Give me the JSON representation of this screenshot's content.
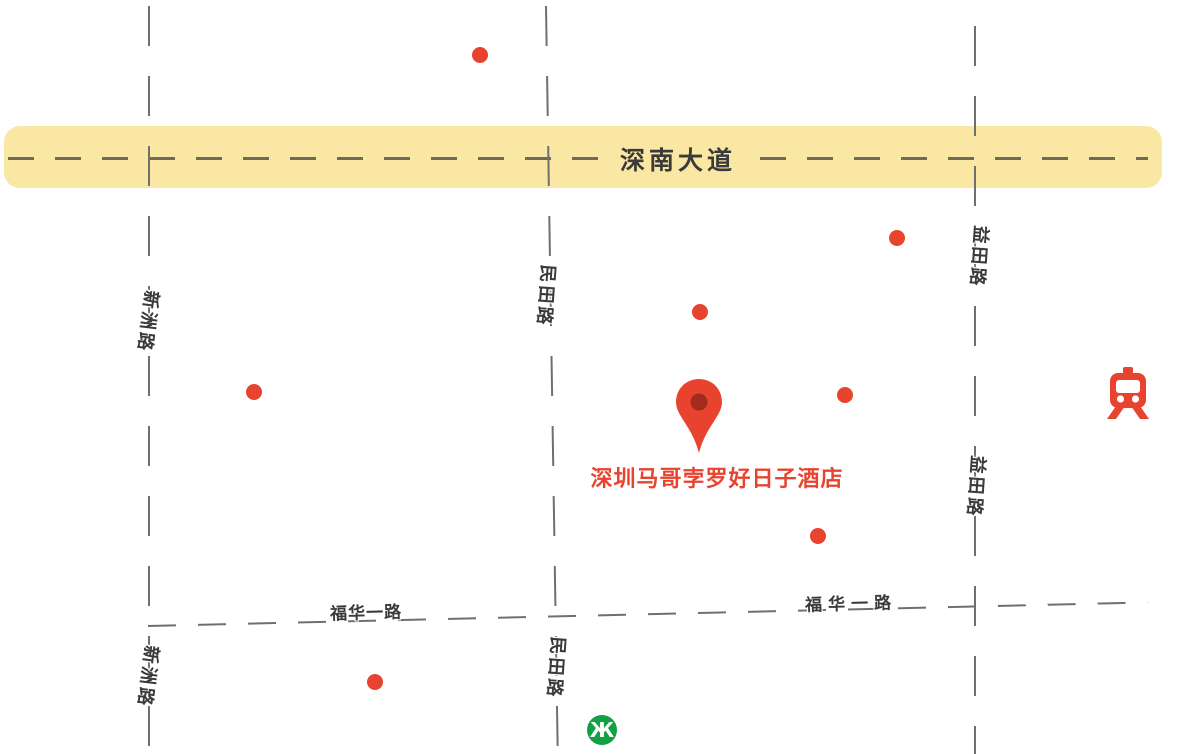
{
  "map": {
    "colors": {
      "background": "#FFFFFF",
      "highway_fill": "#FAE7A3",
      "highway_dash": "#56554D",
      "road_dash": "#6F6F6F",
      "road_label": "#3A3A3A",
      "poi_red": "#E8432F",
      "pin_inner": "#A32B1E",
      "hotel_label": "#E8432F",
      "metro_green": "#12A044"
    },
    "highway": {
      "label": "深南大道"
    },
    "road_labels": {
      "xinzhou_top": "新洲路",
      "xinzhou_bottom": "新洲路",
      "mintian_top": "民田路",
      "mintian_bottom": "民田路",
      "yitian_top": "益田路",
      "yitian_bottom": "益田路",
      "fuhua_left": "福华一路",
      "fuhua_right": "福华一路"
    },
    "hotel": {
      "name": "深圳马哥孛罗好日子酒店"
    },
    "poi_dots": [
      {
        "x": 480,
        "y": 55
      },
      {
        "x": 897,
        "y": 238
      },
      {
        "x": 700,
        "y": 312
      },
      {
        "x": 254,
        "y": 392
      },
      {
        "x": 845,
        "y": 395
      },
      {
        "x": 818,
        "y": 536
      },
      {
        "x": 375,
        "y": 682
      }
    ],
    "pin": {
      "x": 699,
      "y": 453
    },
    "icons": {
      "metro": {
        "glyph": "Ж",
        "x": 602,
        "y": 730
      },
      "railway": {
        "x": 1128,
        "y": 392
      }
    }
  }
}
